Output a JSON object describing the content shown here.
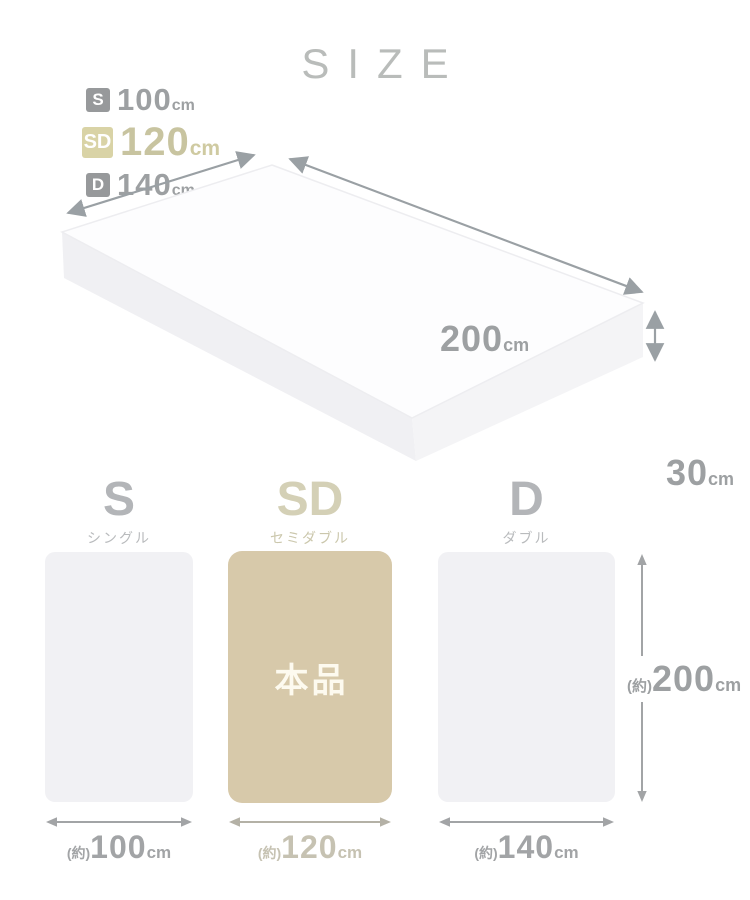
{
  "title": "SIZE",
  "legend": {
    "items": [
      {
        "badge": "S",
        "value": "100",
        "unit": "cm",
        "highlight": false
      },
      {
        "badge": "SD",
        "value": "120",
        "unit": "cm",
        "highlight": true
      },
      {
        "badge": "D",
        "value": "140",
        "unit": "cm",
        "highlight": false
      }
    ]
  },
  "mattress": {
    "length_value": "200",
    "length_unit": "cm",
    "height_value": "30",
    "height_unit": "cm"
  },
  "comparison": {
    "items": [
      {
        "code": "S",
        "name": "シングル",
        "approx": "(約)",
        "width_value": "100",
        "unit": "cm",
        "highlight": false,
        "tag": ""
      },
      {
        "code": "SD",
        "name": "セミダブル",
        "approx": "(約)",
        "width_value": "120",
        "unit": "cm",
        "highlight": true,
        "tag": "本品"
      },
      {
        "code": "D",
        "name": "ダブル",
        "approx": "(約)",
        "width_value": "140",
        "unit": "cm",
        "highlight": false,
        "tag": ""
      }
    ],
    "height_label": {
      "approx": "(約)",
      "value": "200",
      "unit": "cm"
    }
  },
  "colors": {
    "highlight_beige": "#d7c9aa",
    "badge_beige": "#d9d3a6",
    "badge_gray": "#97999b",
    "text_gray": "#9da0a2",
    "panel_gray": "#f1f1f4",
    "arrow_gray": "#9aa0a4",
    "tag_text": "#fdfaef"
  }
}
